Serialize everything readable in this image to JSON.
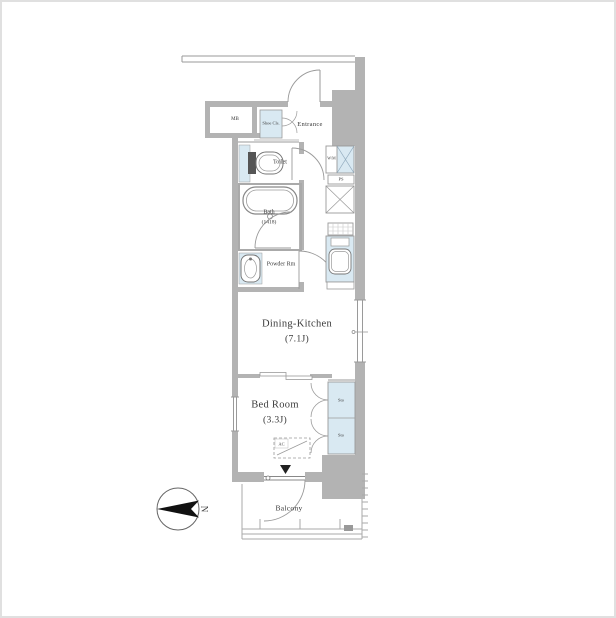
{
  "floor_plan": {
    "rooms": {
      "dining_kitchen": {
        "label": "Dining-Kitchen",
        "size": "(7.1J)"
      },
      "bed_room": {
        "label": "Bed Room",
        "size": "(3.3J)"
      },
      "balcony": {
        "label": "Balcony"
      },
      "entrance": {
        "label": "Entrance"
      },
      "toilet": {
        "label": "Toilet"
      },
      "bath": {
        "label": "Bath",
        "size": "(1418)"
      },
      "powder_room": {
        "label": "Powder Rm"
      },
      "meter_box": {
        "label": "MB"
      },
      "shoe_closet": {
        "label": "Shoe Cls."
      }
    },
    "storage": {
      "sto_upper": "Sto",
      "sto_lower": "Sto"
    },
    "equipment": {
      "washing_machine": "W/M",
      "pipe_space": "PS",
      "air_conditioner": "AC"
    },
    "compass": {
      "north": "N"
    },
    "colors": {
      "wall": "#b3b3b3",
      "fixture_blue": "#d9e9f2",
      "line": "#9a9a9a",
      "text": "#3b3b3b"
    }
  }
}
